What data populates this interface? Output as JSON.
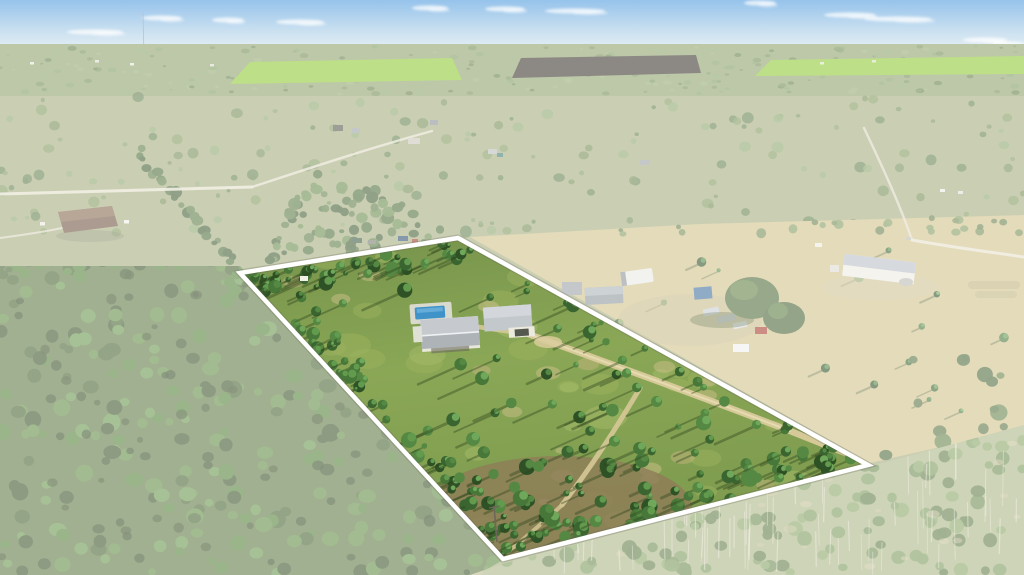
{
  "scene": {
    "type": "aerial-drone-photograph",
    "subject": "Aerial view of rural wooded acreage with a white-outlined highlighted parcel",
    "setting": "Pine flatwoods, pastures and scattered homesteads under a hazy blue sky; outlined parcel contains a house, swimming pool, detached garage and winding dirt trails",
    "highlight": {
      "polygon_points": "240,273 458,238 868,465 503,559",
      "outline_color": "#ffffff",
      "outline_width": 4.5,
      "fade_opacity": 0.42
    },
    "colors": {
      "sky_top": "#4a98dd",
      "sky_mid": "#a8cce6",
      "sky_horizon": "#d8e6ee",
      "cloud": "#ffffff",
      "distant_forest": "#7e9a5e",
      "crop_field_green": "#8ec832",
      "plowed_field_dark": "#3a332a",
      "midland_base": "#a4ac7c",
      "pasture_tan": "#cfc188",
      "road_pale": "#e9e3d1",
      "forest_dark_green": "#4c6b38",
      "parcel_grass": "#86a150",
      "parcel_grass_light": "#a9be6c",
      "dirt_trail": "#d9cb9b",
      "dirt_ground": "#8f7c58",
      "pool_water": "#3f93c9",
      "pool_deck": "#d9d9cd",
      "house_wall": "#e9e7db",
      "house_roof": "#c6cacf",
      "garage_roof": "#c3c8cd",
      "barn_wall": "#eceae2",
      "barn_roof": "#b9bfc6",
      "neighbor_roof_brown": "#6f5440",
      "tree_shadow": "#2f451d",
      "rv_white": "#e9e9e4",
      "blue_equipment": "#3f6f9e",
      "red_truck": "#a83c2e"
    },
    "landmarks": {
      "main_house": "single-story home with light gray roof",
      "swimming_pool": "blue in-ground pool beside house",
      "detached_garage": "gray-roof garage with white gable",
      "power_pole": "utility pole near south corner of parcel",
      "white_barn": "long white barn on neighboring pasture",
      "neighbor_house": "brown-roof house on left acreage",
      "farm_cluster": "sheds, RV and vehicles on adjacent lot",
      "antenna_mast": "thin distant tower on horizon"
    }
  }
}
